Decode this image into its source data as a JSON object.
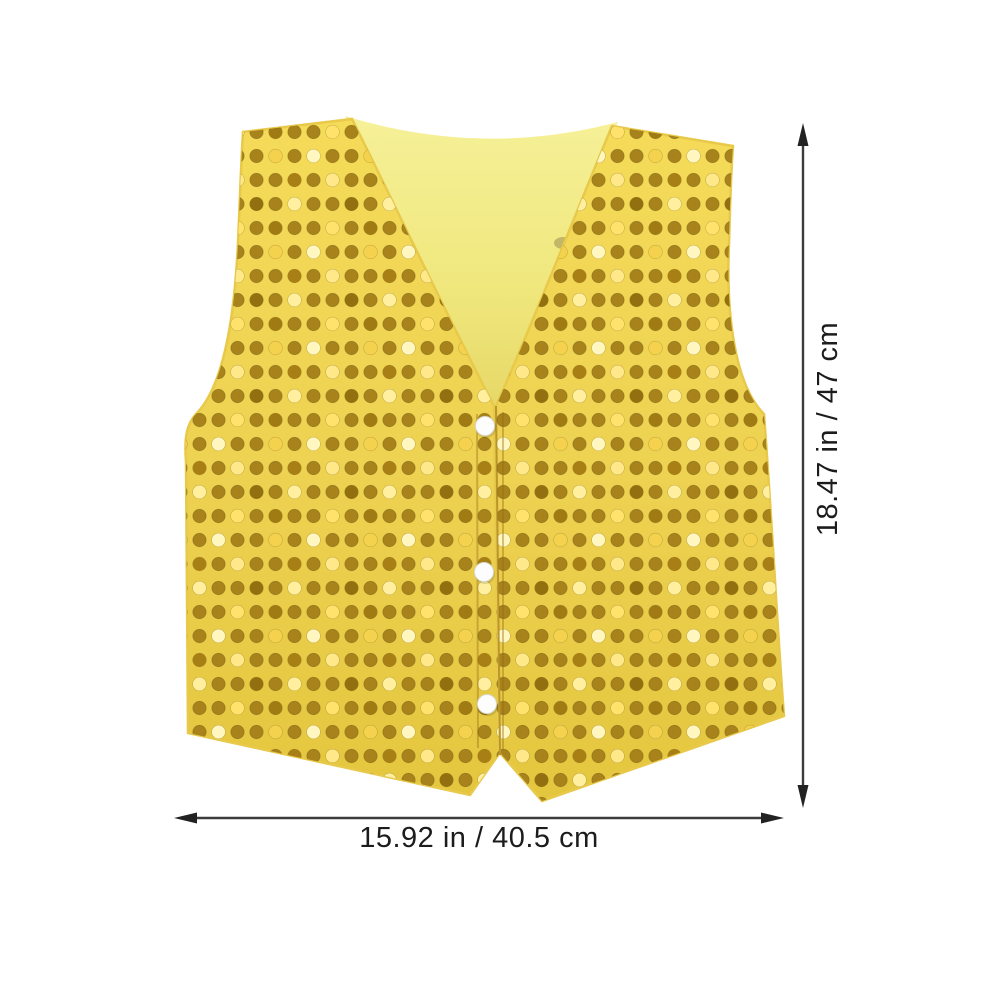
{
  "product": {
    "semantic_name": "gold-sequin-vest",
    "style": {
      "fabric_color": "#eed252",
      "fabric_color_dark": "#e3c33e",
      "sequin_color": "#a8831c",
      "sequin_glint_light": "#ffe878",
      "sequin_glint_dark": "#7d620f",
      "lining_color": "#f3ee8a",
      "lining_shade_color": "#e3d463",
      "button_color": "#fdfdfd",
      "button_count": 3
    }
  },
  "dimensions": {
    "height": {
      "label": "18.47 in / 47 cm"
    },
    "width": {
      "label": "15.92 in / 40.5 cm"
    },
    "line_color": "#3c3c3c",
    "text_color": "#1c1c1c"
  }
}
